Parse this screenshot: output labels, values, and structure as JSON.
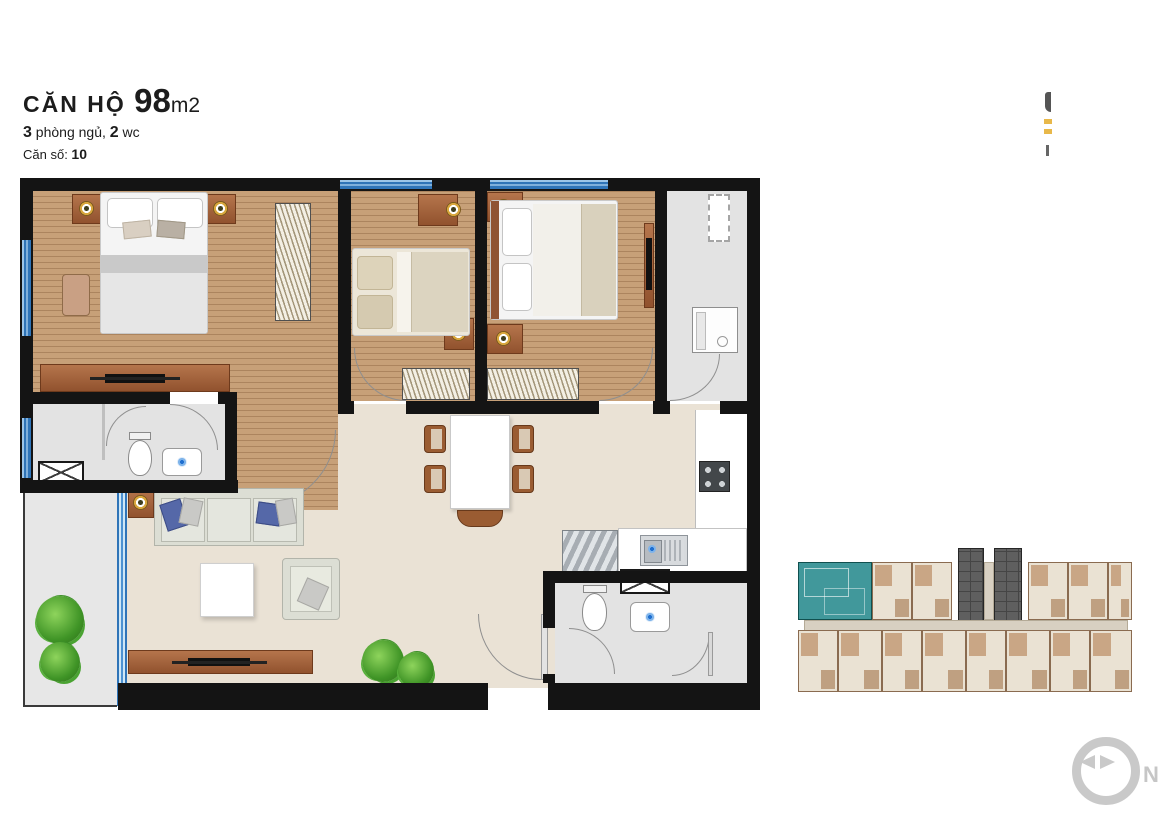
{
  "header": {
    "title": "CĂN HỘ",
    "area_value": "98",
    "area_unit": "m2",
    "bed_count": "3",
    "bed_label": " phòng ngủ, ",
    "wc_count": "2",
    "wc_label": " wc",
    "unit_no_label": "Căn số: ",
    "unit_no": "10"
  },
  "compass": {
    "north_label": "N"
  },
  "legend_colors": {
    "wall": "#141414",
    "wood_floor": "#c7a078",
    "living_floor": "#eae2d5",
    "wet_area_floor": "#e3e3e3",
    "window_glass": "#4d92d2",
    "furniture_wood": "#a4613c",
    "keyplan_highlight": "#41989b"
  },
  "keyplan": {
    "top_row": [
      {
        "w": 74,
        "t": "highlight"
      },
      {
        "w": 40,
        "t": "unit"
      },
      {
        "w": 40,
        "t": "unit"
      },
      {
        "w": 6,
        "t": "gap"
      },
      {
        "w": 26,
        "t": "core"
      },
      {
        "w": 10,
        "t": "hall"
      },
      {
        "w": 28,
        "t": "core"
      },
      {
        "w": 6,
        "t": "gap"
      },
      {
        "w": 40,
        "t": "unit"
      },
      {
        "w": 40,
        "t": "unit"
      },
      {
        "w": 24,
        "t": "unit"
      }
    ],
    "bottom_row": [
      {
        "w": 40,
        "t": "unit"
      },
      {
        "w": 44,
        "t": "unit"
      },
      {
        "w": 40,
        "t": "unit"
      },
      {
        "w": 44,
        "t": "unit"
      },
      {
        "w": 40,
        "t": "unit"
      },
      {
        "w": 44,
        "t": "unit"
      },
      {
        "w": 40,
        "t": "unit"
      },
      {
        "w": 42,
        "t": "unit"
      }
    ]
  }
}
